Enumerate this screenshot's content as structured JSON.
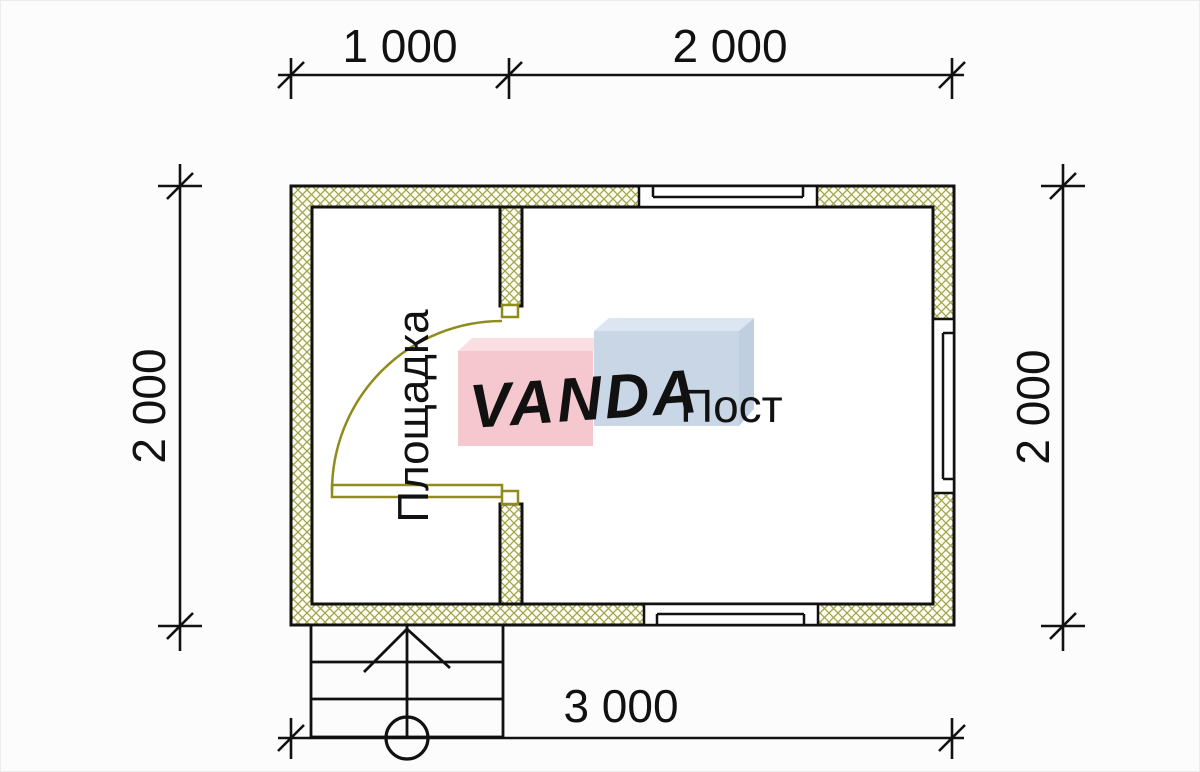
{
  "dimensions": {
    "top_segment_1": "1 000",
    "top_segment_2": "2 000",
    "left": "2 000",
    "right": "2 000",
    "bottom": "3 000"
  },
  "rooms": {
    "left_label": "Площадка",
    "right_label": "Пост"
  },
  "watermark": {
    "text": "VANDA"
  },
  "colors": {
    "background": "#fcfcfc",
    "line": "#111111",
    "wall_hatch": "#a3a34f",
    "wall_fill": "#fdfdf2",
    "door": "#8f8c1c",
    "watermark_pink": "#f5c8cf",
    "watermark_pink_top": "#fadee2",
    "watermark_blue": "#c8d6e6",
    "watermark_blue_top": "#dbe6f2",
    "watermark_side_blue": "#c0cfe0",
    "watermark_text": "#ffffff"
  }
}
